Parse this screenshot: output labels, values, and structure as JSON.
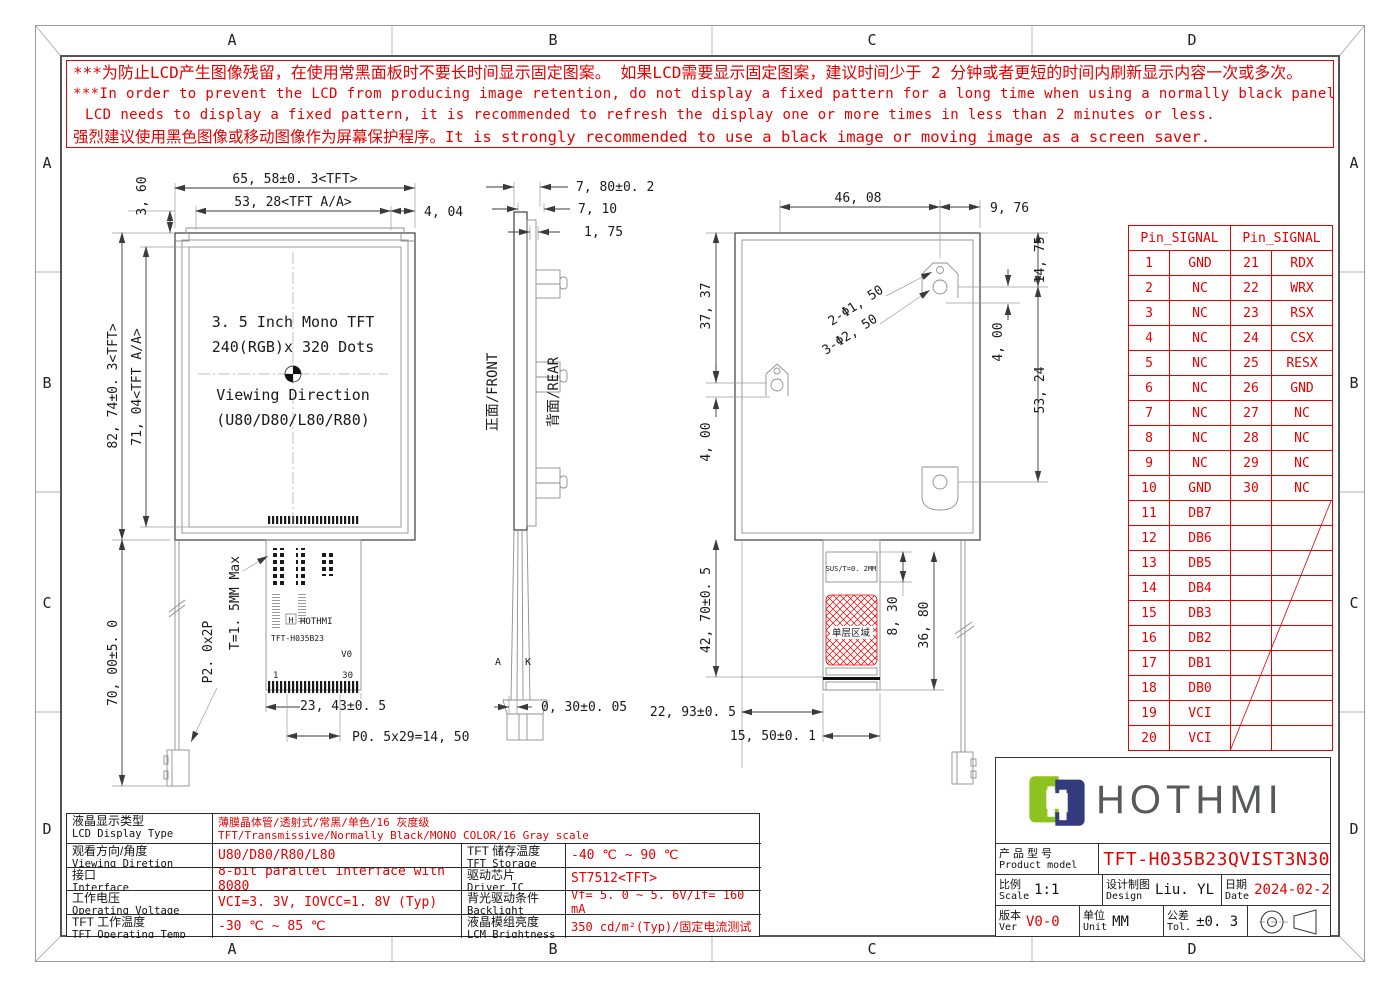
{
  "zones": {
    "cols": [
      "A",
      "B",
      "C",
      "D"
    ],
    "rows": [
      "A",
      "B",
      "C",
      "D"
    ]
  },
  "warning": {
    "l1": "***为防止LCD产生图像残留，在使用常黑面板时不要长时间显示固定图案。 如果LCD需要显示固定图案，建议时间少于 2 分钟或者更短的时间内刷新显示内容一次或多次。",
    "l2": "***In order to prevent the LCD from producing image retention, do not display a fixed pattern for a long time when using a normally black panel.If the",
    "l3": "LCD needs to display a fixed pattern,  it is recommended to refresh the display one or more times in less than 2 minutes or less.",
    "l4": "强烈建议使用黑色图像或移动图像作为屏幕保护程序。It is strongly recommended to use a black image or moving image as a screen saver."
  },
  "front": {
    "dim_width": "65, 58±0. 3<TFT>",
    "dim_aa_width": "53, 28<TFT A/A>",
    "dim_offset": "4, 04",
    "dim_top": "3, 60",
    "dim_height": "82, 74±0. 3<TFT>",
    "dim_aa_height": "71, 04<TFT A/A>",
    "dim_fpc_len": "70, 00±5. 0",
    "label_bl_pitch": "P2. 0x2P",
    "label_thick": "T=1. 5MM Max",
    "line1": "3. 5 Inch Mono TFT",
    "line2": "240(RGB)x 320 Dots",
    "line3": "Viewing Direction",
    "line4": "(U80/D80/L80/R80)",
    "fpc_brand": "HOTHMI",
    "fpc_model": "TFT-H035B23",
    "fpc_ver": "V0",
    "fpc_pin1": "1",
    "fpc_pin30": "30",
    "dim_fpc_w": "23, 43±0. 5",
    "dim_pitch": "P0. 5x29=14, 50"
  },
  "side": {
    "dim_total": "7, 80±0. 2",
    "dim_mid": "7, 10",
    "dim_small": "1, 75",
    "label_front": "正面/FRONT",
    "label_rear": "背面/REAR",
    "dim_fpc_t": "0, 30±0. 05",
    "anode": "A",
    "cathode": "K"
  },
  "rear": {
    "dim_4608": "46, 08",
    "dim_976": "9, 76",
    "dim_1475": "14, 75",
    "dim_3737": "37, 37",
    "dim_400_left": "4, 00",
    "dim_400_right": "4, 00",
    "dim_5324": "53, 24",
    "callout_holes_small": "2-Φ1, 50",
    "callout_holes_big": "3-Φ2, 50",
    "dim_4270": "42, 70±0. 5",
    "label_sus": "SUS/T=0. 2MM",
    "label_single": "单层区域",
    "dim_830": "8, 30",
    "dim_3680": "36, 80",
    "dim_2293": "22, 93±0. 5",
    "dim_1550": "15, 50±0. 1"
  },
  "pin_table": {
    "header_left": "Pin_SIGNAL",
    "header_right": "Pin_SIGNAL",
    "rows": [
      [
        "1",
        "GND",
        "21",
        "RDX"
      ],
      [
        "2",
        "NC",
        "22",
        "WRX"
      ],
      [
        "3",
        "NC",
        "23",
        "RSX"
      ],
      [
        "4",
        "NC",
        "24",
        "CSX"
      ],
      [
        "5",
        "NC",
        "25",
        "RESX"
      ],
      [
        "6",
        "NC",
        "26",
        "GND"
      ],
      [
        "7",
        "NC",
        "27",
        "NC"
      ],
      [
        "8",
        "NC",
        "28",
        "NC"
      ],
      [
        "9",
        "NC",
        "29",
        "NC"
      ],
      [
        "10",
        "GND",
        "30",
        "NC"
      ],
      [
        "11",
        "DB7",
        "",
        ""
      ],
      [
        "12",
        "DB6",
        "",
        ""
      ],
      [
        "13",
        "DB5",
        "",
        ""
      ],
      [
        "14",
        "DB4",
        "",
        ""
      ],
      [
        "15",
        "DB3",
        "",
        ""
      ],
      [
        "16",
        "DB2",
        "",
        ""
      ],
      [
        "17",
        "DB1",
        "",
        ""
      ],
      [
        "18",
        "DB0",
        "",
        ""
      ],
      [
        "19",
        "VCI",
        "",
        ""
      ],
      [
        "20",
        "VCI",
        "",
        ""
      ]
    ]
  },
  "specs": {
    "r1_cn": "液晶显示类型",
    "r1_en": "LCD Display Type",
    "r1_val_cn": "薄膜晶体管/透射式/常黑/单色/16 灰度级",
    "r1_val_en": "TFT/Transmissive/Normally Black/MONO COLOR/16 Gray scale",
    "r2_cn": "观看方向/角度",
    "r2_en": "Viewing Diretion",
    "r2_val": "U80/D80/R80/L80",
    "r2b_cn": "TFT 储存温度",
    "r2b_en": "TFT Storage Temp",
    "r2b_val": "-40 ℃ ~ 90 ℃",
    "r3_cn": "接口",
    "r3_en": "Interface",
    "r3_val": "8-bit parallel interface with 8080",
    "r3b_cn": "驱动芯片",
    "r3b_en": "Driver IC",
    "r3b_val": "ST7512<TFT>",
    "r4_cn": "工作电压",
    "r4_en": "Operating Voltage",
    "r4_val": "VCI=3. 3V, IOVCC=1. 8V (Typ)",
    "r4b_cn": "背光驱动条件",
    "r4b_en": "Backlight conditions",
    "r4b_val": "Vf= 5. 0 ~ 5. 6V/If= 160 mA",
    "r5_cn": "TFT 工作温度",
    "r5_en": "TFT Operating Temp",
    "r5_val": "-30 ℃ ~ 85 ℃",
    "r5b_cn": "液晶模组亮度",
    "r5b_en": "LCM Brightness",
    "r5b_val": "350 cd/m²(Typ)/固定电流测试"
  },
  "title_block": {
    "brand": "HOTHMI",
    "model_label_cn": "产 品 型 号",
    "model_label_en": "Product model",
    "model": "TFT-H035B23QVIST3N30",
    "scale_cn": "比例",
    "scale_en": "Scale",
    "scale_val": "1:1",
    "design_cn": "设计制图",
    "design_en": "Design",
    "design_val": "Liu. YL",
    "date_cn": "日期",
    "date_en": "Date",
    "date_val": "2024-02-27",
    "ver_cn": "版本",
    "ver_en": "Ver",
    "ver_val": "V0-0",
    "unit_cn": "单位",
    "unit_en": "Unit",
    "unit_val": "MM",
    "tol_cn": "公差",
    "tol_en": "Tol.",
    "tol_val": "±0. 3"
  },
  "colors": {
    "accent_red": "#e60000",
    "logo_green": "#8dc21f",
    "logo_navy": "#333a7d",
    "line_dark": "#4a4a4a"
  }
}
